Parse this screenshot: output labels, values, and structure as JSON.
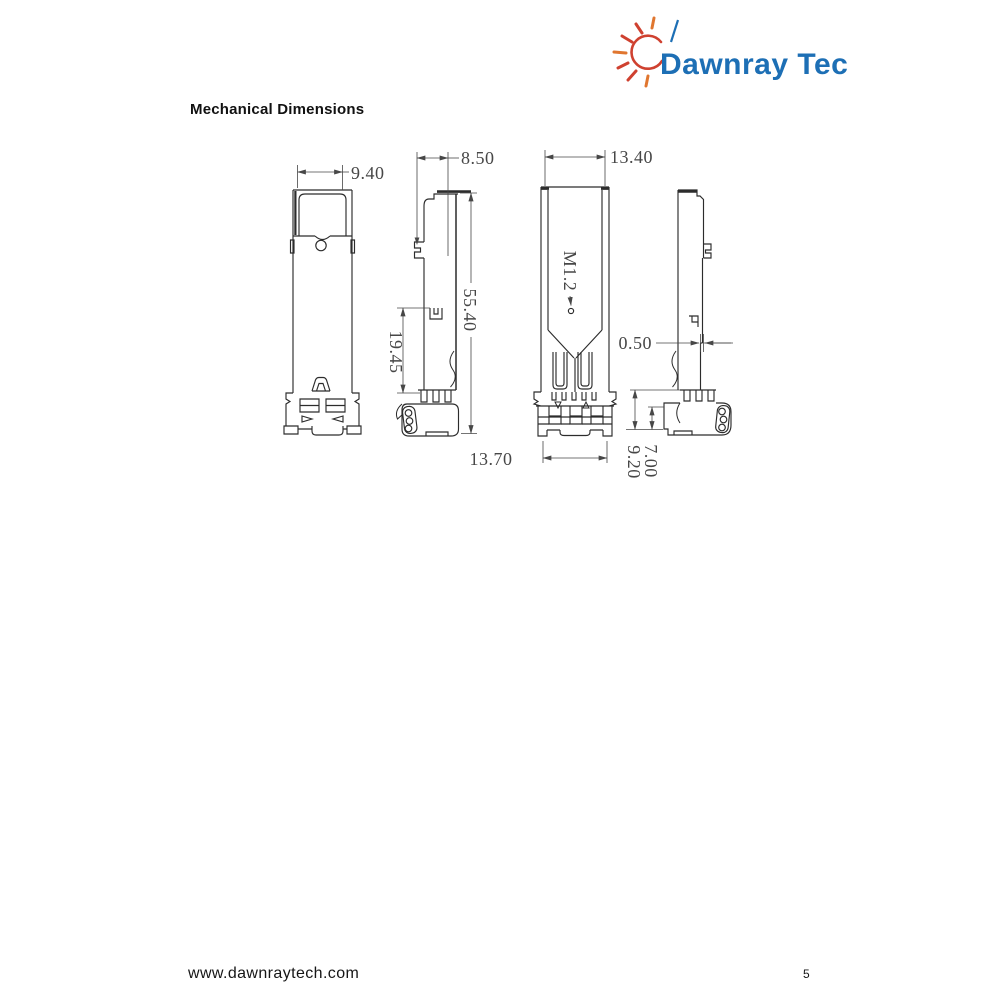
{
  "theme": {
    "ink": "#2c2c2c",
    "dim": "#474747",
    "logo-blue": "#1d6fb5",
    "logo-red": "#cf4130",
    "logo-orange": "#e0762f"
  },
  "logo": {
    "text": "Dawnray Tech"
  },
  "page": {
    "title": "Mechanical Dimensions",
    "footer_url": "www.dawnraytech.com",
    "page_number": "5"
  },
  "drawing": {
    "description": "Four orthographic views of SFP transceiver module",
    "dimensions": {
      "front_width": "9.40",
      "side_width": "8.50",
      "overall_length": "55.40",
      "spring_to_end": "19.45",
      "body_width": "13.40",
      "connector_width": "13.70",
      "screw_thread": "M1.2",
      "edge_step": "0.50",
      "tail_height_inner": "7.00",
      "tail_height_outer": "9.20"
    }
  }
}
